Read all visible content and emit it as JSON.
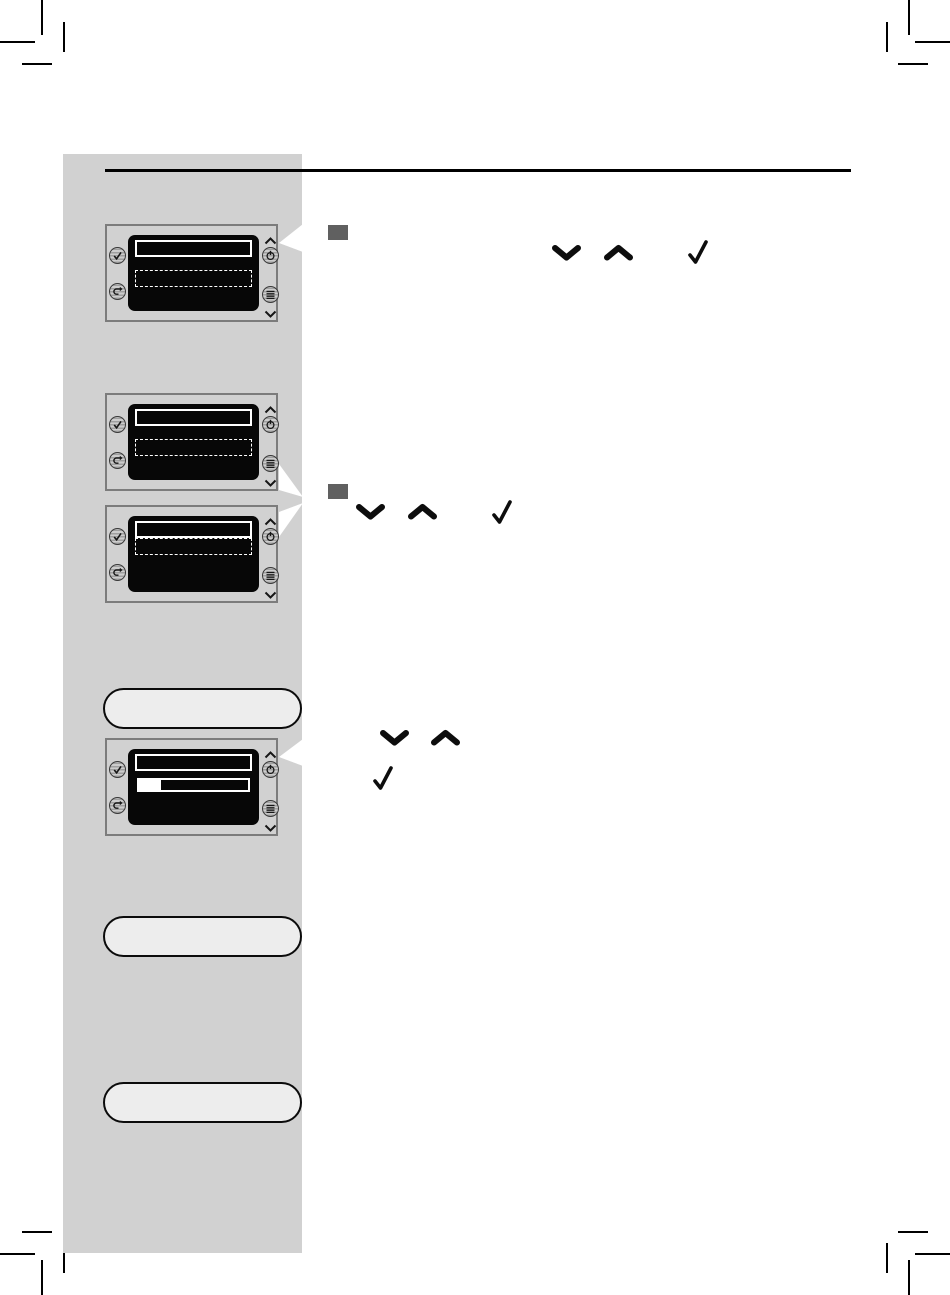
{
  "page": {
    "background": "#ffffff",
    "kind": "appliance-user-manual-page",
    "visible_text": ""
  },
  "colors": {
    "sidebar": "#d1d1d1",
    "header_rule": "#000000",
    "panel_border": "#7c7c7c",
    "display_bg": "#070707",
    "display_row_border": "#ffffff",
    "pill_fill": "#ededed",
    "pill_border": "#0b0b0b",
    "step_bullet": "#606060",
    "glyph": "#0d0d0d",
    "crop_mark": "#000000"
  },
  "header": {
    "rule_present": true
  },
  "steps": [
    {
      "bullet": true,
      "inline_icons": [
        "chevron-down-icon",
        "chevron-up-icon",
        "check-icon"
      ]
    },
    {
      "bullet": true,
      "inline_icons": [
        "chevron-down-icon",
        "chevron-up-icon",
        "check-icon"
      ]
    },
    {
      "bullet": false,
      "inline_icons": [
        "chevron-down-icon",
        "chevron-up-icon",
        "check-icon"
      ]
    }
  ],
  "panels": [
    {
      "buttons": [
        "ok-button",
        "esc-button",
        "standby-button",
        "menu-button"
      ],
      "nav_icons": [
        "chevron-up",
        "chevron-down"
      ],
      "display_rows": [
        "selected-solid-outline",
        "dashed-outline"
      ],
      "row_layout": "spaced",
      "pointer": "top-right"
    },
    {
      "buttons": [
        "ok-button",
        "esc-button",
        "standby-button",
        "menu-button"
      ],
      "nav_icons": [
        "chevron-up",
        "chevron-down"
      ],
      "display_rows": [
        "selected-solid-outline",
        "dashed-outline"
      ],
      "row_layout": "spaced",
      "pointer": "bottom-right"
    },
    {
      "buttons": [
        "ok-button",
        "esc-button",
        "standby-button",
        "menu-button"
      ],
      "nav_icons": [
        "chevron-up",
        "chevron-down"
      ],
      "display_rows": [
        "selected-solid-outline",
        "dashed-outline"
      ],
      "row_layout": "adjacent",
      "pointer": "top-right"
    },
    {
      "buttons": [
        "ok-button",
        "esc-button",
        "standby-button",
        "menu-button"
      ],
      "nav_icons": [
        "chevron-up",
        "chevron-down"
      ],
      "display_rows": [
        "selected-solid-outline",
        "progress-bar"
      ],
      "row_layout": "spaced",
      "pointer": "top-right",
      "progress_percent": 20,
      "progress_fill_style": "width:20%"
    }
  ],
  "callout_pills": [
    {
      "shape": "rounded-pill",
      "text": ""
    },
    {
      "shape": "rounded-pill",
      "text": ""
    },
    {
      "shape": "rounded-pill",
      "text": ""
    }
  ],
  "crop_marks": {
    "corners": [
      "top-left",
      "top-right",
      "bottom-left",
      "bottom-right"
    ]
  }
}
